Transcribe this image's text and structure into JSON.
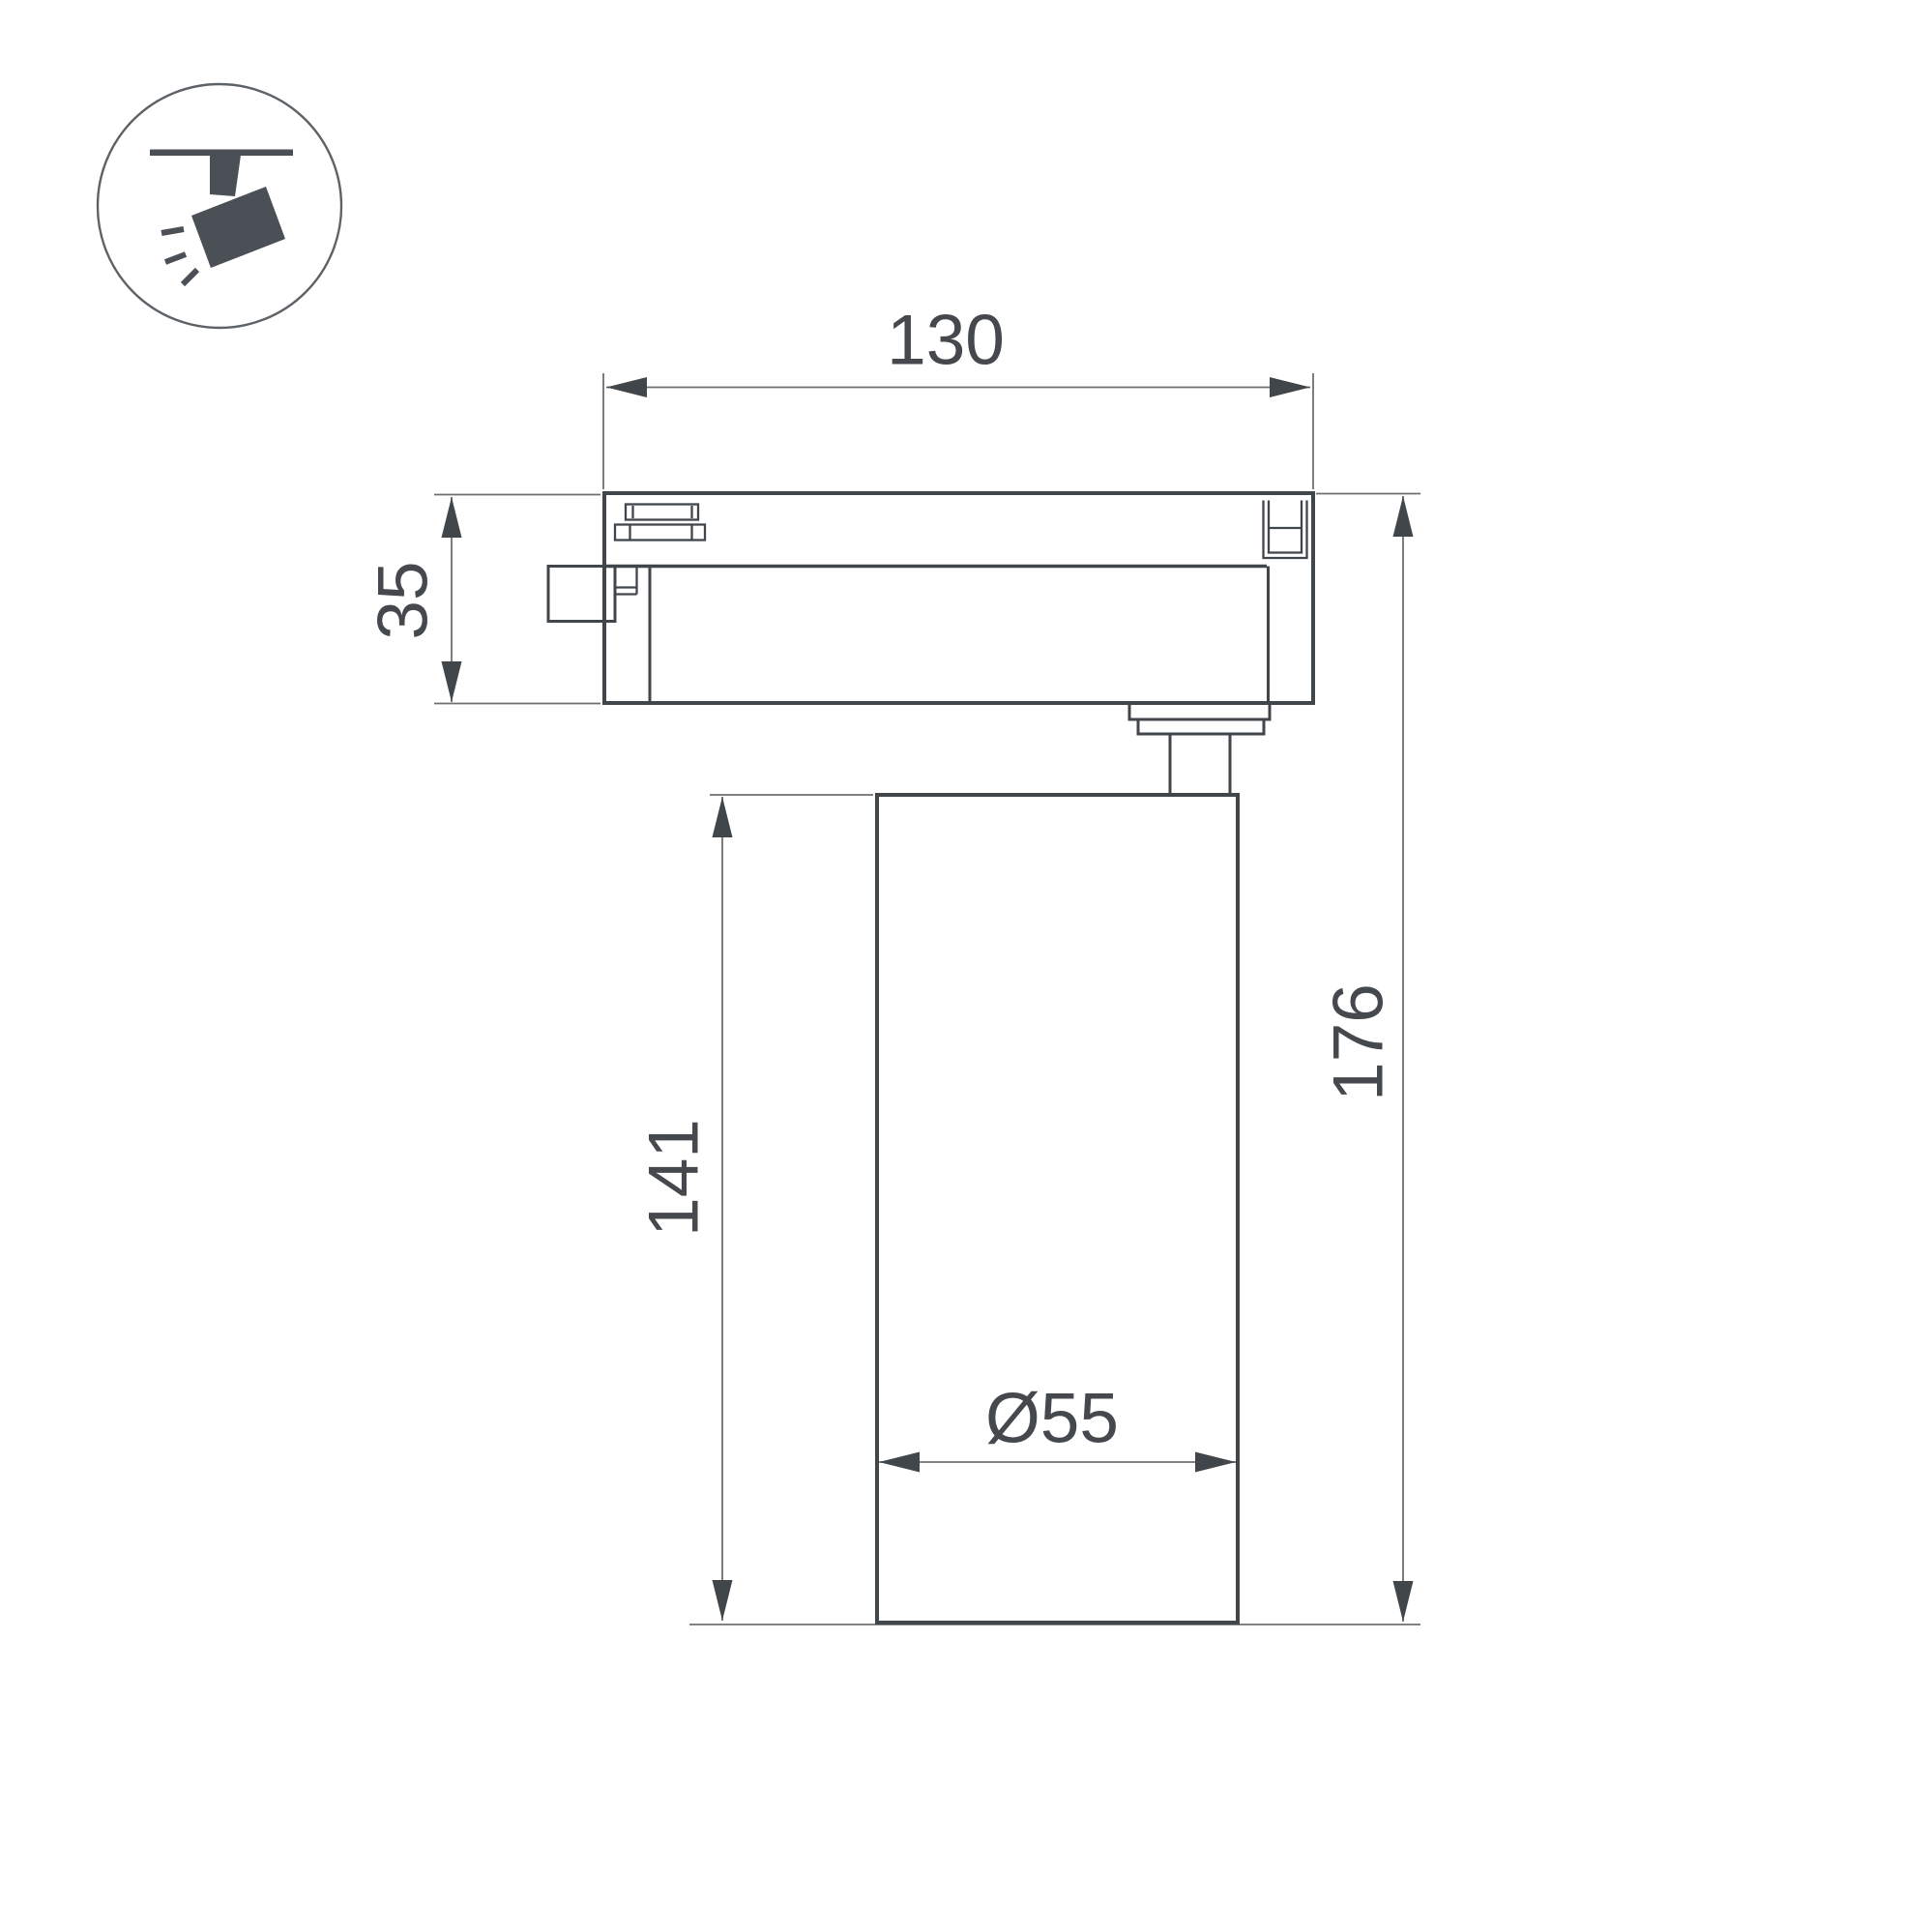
{
  "drawing": {
    "title_icon": "ceiling-track-spotlight-icon",
    "dimensions": {
      "top_width": "130",
      "adapter_height": "35",
      "body_height": "141",
      "total_height": "176",
      "body_diameter": "Ø55"
    }
  },
  "colors": {
    "outline_dark": "#41464b",
    "dimension_thin": "#6f6f6f",
    "text_color": "#45494d",
    "icon_fill": "#4a5055",
    "icon_circle_stroke": "#5d6267",
    "background": "#ffffff"
  }
}
